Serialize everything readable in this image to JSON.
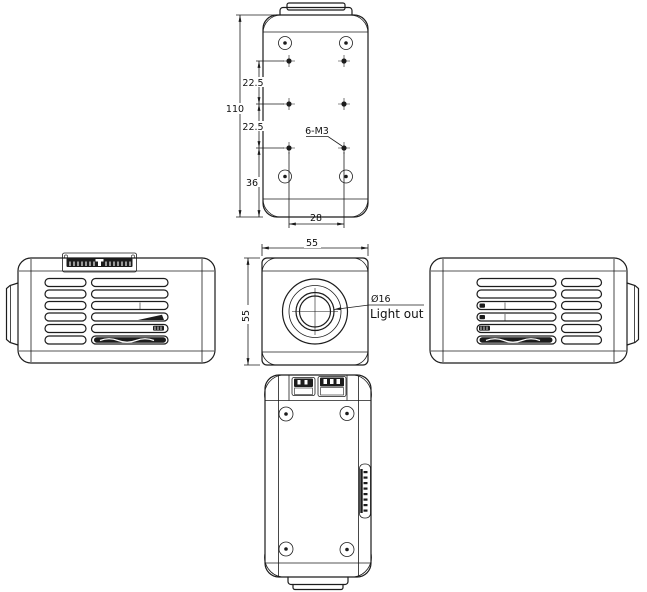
{
  "drawing": {
    "type": "engineering-orthographic-views",
    "colors": {
      "line": "#1c1c1c",
      "background": "#ffffff",
      "text": "#111111"
    },
    "labels": {
      "top_view": {
        "overall_length": "110",
        "hole_pitch_a": "22.5",
        "hole_pitch_b": "22.5",
        "end_offset": "36",
        "hole_span": "28",
        "thread_callout": "6-M3"
      },
      "front_view": {
        "width": "55",
        "height": "55",
        "aperture_diameter": "Ø16",
        "aperture_note": "Light out"
      }
    }
  }
}
